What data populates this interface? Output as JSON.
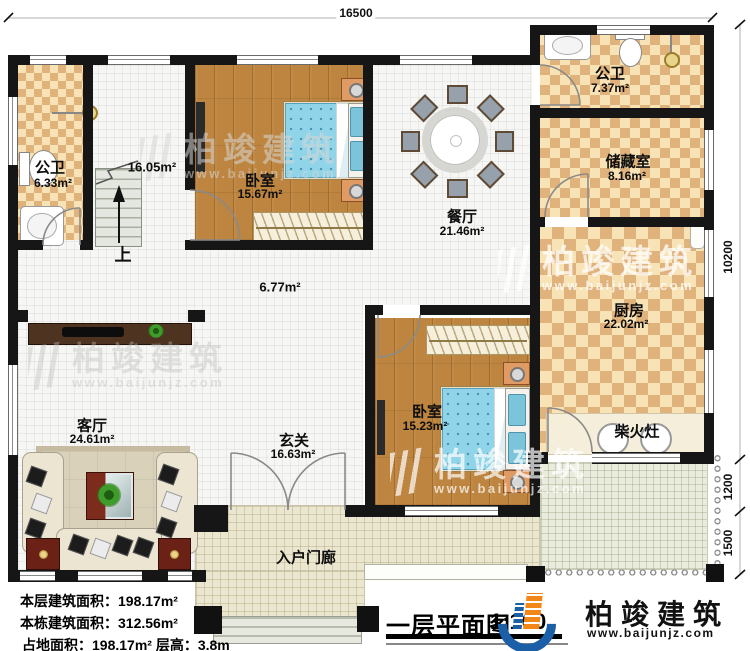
{
  "dims": {
    "width": "16500",
    "right": [
      "10200",
      "1200",
      "1500"
    ]
  },
  "rooms": {
    "bath1": {
      "name": "公卫",
      "area": "6.33m²"
    },
    "stairhall": {
      "area": "16.05m²",
      "up": "上"
    },
    "bedroom1": {
      "name": "卧室",
      "area": "15.67m²"
    },
    "hallway": {
      "area": "6.77m²"
    },
    "dining": {
      "name": "餐厅",
      "area": "21.46m²"
    },
    "bath2": {
      "name": "公卫",
      "area": "7.37m²"
    },
    "storage": {
      "name": "储藏室",
      "area": "8.16m²"
    },
    "kitchen": {
      "name": "厨房",
      "area": "22.02m²"
    },
    "stove": {
      "name": "柴火灶"
    },
    "bedroom2": {
      "name": "卧室",
      "area": "15.23m²"
    },
    "foyer": {
      "name": "玄关",
      "area": "16.63m²"
    },
    "living": {
      "name": "客厅",
      "area": "24.61m²"
    },
    "porch": {
      "name": "入户门廊"
    }
  },
  "stats": {
    "floor_area": "本层建筑面积：198.17m²",
    "total_area": "本栋建筑面积：312.56m²",
    "footprint": "占地面积：198.17m²  层高：3.8m"
  },
  "title": {
    "text": "一层平面图",
    "scale": "1:100"
  },
  "brand": {
    "name": "柏竣建筑",
    "url": "www.baijunjz.com"
  },
  "colors": {
    "wall": "#161616",
    "brand_blue": "#1b5fa7",
    "brand_orange": "#f28718"
  }
}
